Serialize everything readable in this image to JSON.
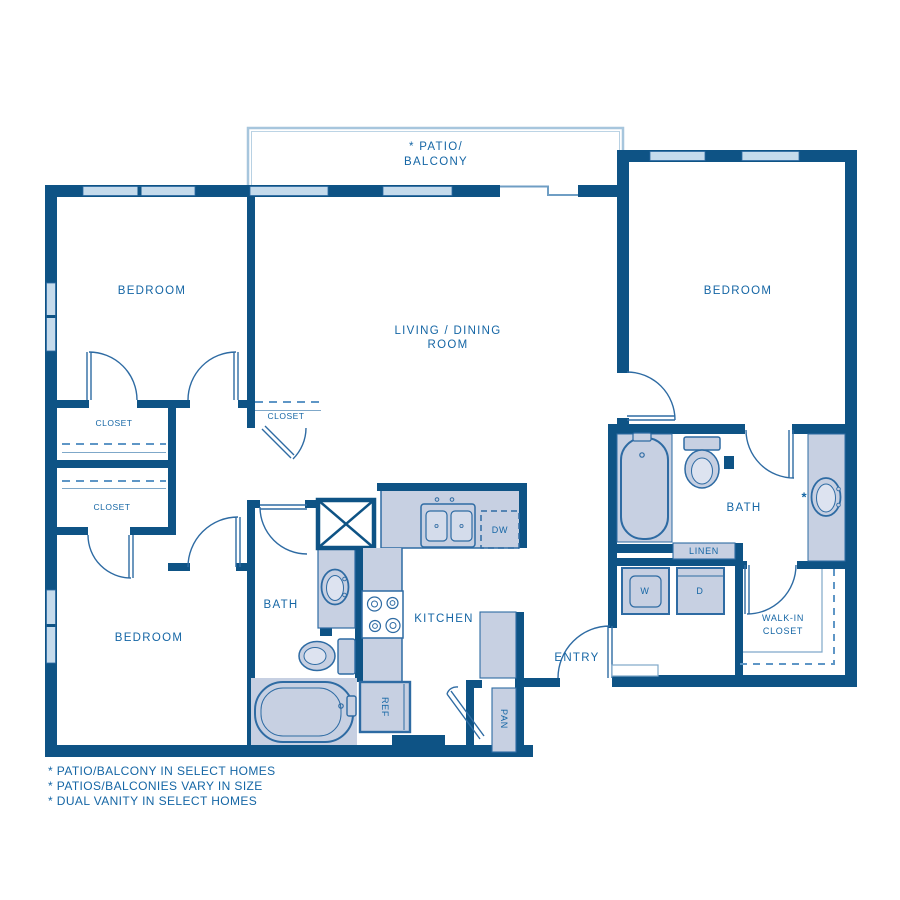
{
  "title": "2 Bedroom Floor Plan",
  "colors": {
    "wall": "#0E5385",
    "fixture_stroke": "#2E6BA3",
    "fixture_fill": "#C7D0E2",
    "window_fill": "#C5DBEC",
    "dashed_line": "#5E96C6",
    "balcony_outline": "#A7C6DD",
    "label_text": "#1566A5",
    "background": "#FFFFFF"
  },
  "rooms": {
    "patio_balcony": {
      "line1": "* PATIO/",
      "line2": "BALCONY"
    },
    "bedroom_top_left": "BEDROOM",
    "bedroom_top_right": "BEDROOM",
    "bedroom_bottom_left": "BEDROOM",
    "living_dining": {
      "line1": "LIVING / DINING",
      "line2": "ROOM"
    },
    "kitchen": "KITCHEN",
    "entry": "ENTRY",
    "bath_middle": "BATH",
    "bath_right": "BATH",
    "walk_in_closet": {
      "line1": "WALK-IN",
      "line2": "CLOSET"
    },
    "closet_left_upper": "CLOSET",
    "closet_left_lower": "CLOSET",
    "closet_hall": "CLOSET",
    "linen": "LINEN"
  },
  "appliances": {
    "washer": "W",
    "dryer": "D",
    "dishwasher": "DW",
    "refrigerator": "REF",
    "pantry": "PAN"
  },
  "annotations": {
    "dual_vanity_asterisk": "*"
  },
  "footnotes": [
    "* PATIO/BALCONY IN SELECT HOMES",
    "* PATIOS/BALCONIES VARY IN SIZE",
    "* DUAL VANITY IN SELECT HOMES"
  ]
}
